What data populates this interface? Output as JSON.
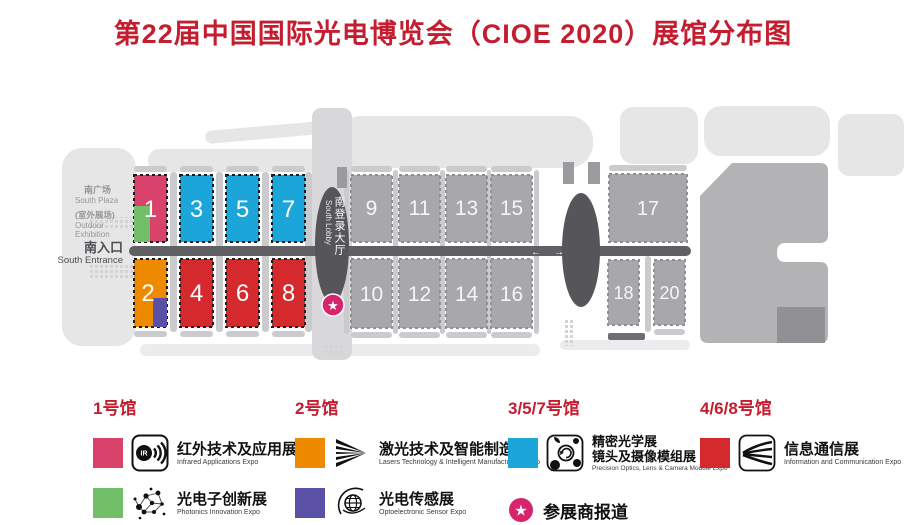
{
  "title": {
    "text": "第22届中国国际光电博览会（CIOE 2020）展馆分布图",
    "color": "#c41d2f"
  },
  "colors": {
    "title_red": "#c41d2f",
    "hall_pink": "#d8426b",
    "hall_green": "#72bf6a",
    "hall_cyan": "#1ca5d8",
    "hall_orange": "#ee8a00",
    "hall_purple": "#5a51a6",
    "hall_red": "#d42a2e",
    "hall_gray": "#a8a8ac",
    "corridor_gray": "#606064",
    "lobby_dark": "#55555a",
    "star_pink": "#d6246d"
  },
  "map": {
    "labels": {
      "south_plaza_cn": "南广场",
      "south_plaza_en": "South Plaza",
      "outdoor_cn": "(室外展场)",
      "outdoor_en1": "Outdoor",
      "outdoor_en2": "Exhibition",
      "south_entrance_cn": "南入口",
      "south_entrance_en": "South Entrance",
      "south_lobby_cn": "南登录大厅",
      "south_lobby_en": "South Lobby",
      "arrow_left": "←",
      "arrow_right": "→",
      "star": "★"
    },
    "halls": {
      "h1": {
        "num": "1",
        "color": "#d8426b",
        "sub_color": "#72bf6a"
      },
      "h2": {
        "num": "2",
        "color": "#ee8a00",
        "sub_color": "#5a51a6"
      },
      "h3": {
        "num": "3",
        "color": "#1ca5d8"
      },
      "h4": {
        "num": "4",
        "color": "#d42a2e"
      },
      "h5": {
        "num": "5",
        "color": "#1ca5d8"
      },
      "h6": {
        "num": "6",
        "color": "#d42a2e"
      },
      "h7": {
        "num": "7",
        "color": "#1ca5d8"
      },
      "h8": {
        "num": "8",
        "color": "#d42a2e"
      },
      "h9": {
        "num": "9",
        "color": "#a8a8ac"
      },
      "h10": {
        "num": "10",
        "color": "#a8a8ac"
      },
      "h11": {
        "num": "11",
        "color": "#a8a8ac"
      },
      "h12": {
        "num": "12",
        "color": "#a8a8ac"
      },
      "h13": {
        "num": "13",
        "color": "#a8a8ac"
      },
      "h14": {
        "num": "14",
        "color": "#a8a8ac"
      },
      "h15": {
        "num": "15",
        "color": "#a8a8ac"
      },
      "h16": {
        "num": "16",
        "color": "#a8a8ac"
      },
      "h17": {
        "num": "17",
        "color": "#a8a8ac"
      },
      "h18": {
        "num": "18",
        "color": "#a8a8ac"
      },
      "h20": {
        "num": "20",
        "color": "#a8a8ac"
      }
    }
  },
  "legend": {
    "s1": {
      "header": "1号馆",
      "item1": {
        "color": "#d8426b",
        "cn": "红外技术及应用展",
        "en": "Infrared Applications Expo"
      },
      "item2": {
        "color": "#72bf6a",
        "cn": "光电子创新展",
        "en": "Photonics Innovation Expo"
      }
    },
    "s2": {
      "header": "2号馆",
      "item1": {
        "color": "#ee8a00",
        "cn": "激光技术及智能制造展",
        "en": "Lasers Technology & Intelligent Manufacturing Expo"
      },
      "item2": {
        "color": "#5a51a6",
        "cn": "光电传感展",
        "en": "Optoelectronic Sensor Expo"
      }
    },
    "s3": {
      "header": "3/5/7号馆",
      "item1": {
        "color": "#1ca5d8",
        "cn1": "精密光学展",
        "cn2": "镜头及摄像模组展",
        "en": "Precision Optics, Lens & Camera Module Expo"
      },
      "checkin": {
        "star": "★",
        "cn": "参展商报道"
      }
    },
    "s4": {
      "header": "4/6/8号馆",
      "item1": {
        "color": "#d42a2e",
        "cn": "信息通信展",
        "en": "Information and Communication Expo"
      }
    }
  }
}
